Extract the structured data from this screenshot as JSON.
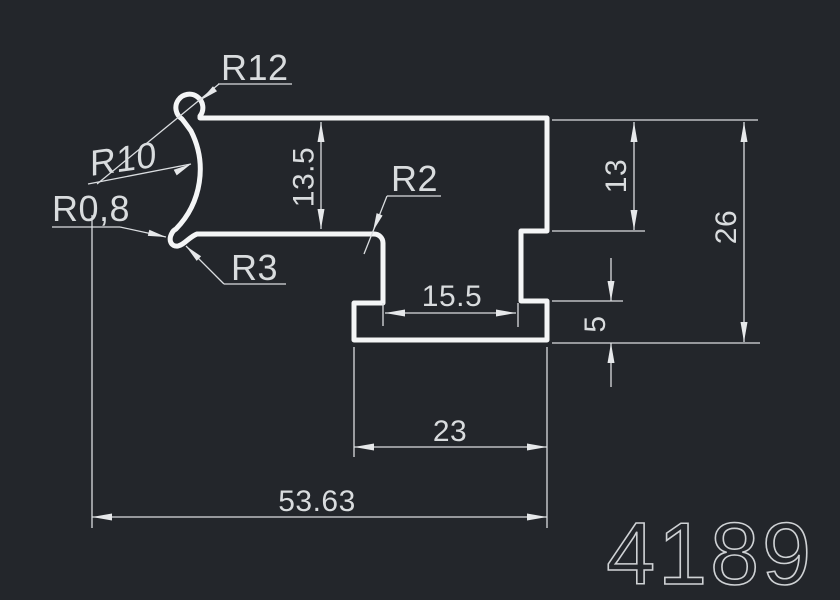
{
  "drawing": {
    "part_number": "4189",
    "background_color": "#23262b",
    "profile_stroke_color": "#f4f5f6",
    "dimension_line_color": "#dadde0",
    "text_color": "#d9dcde"
  },
  "dimensions": {
    "height_top_bar": "13.5",
    "height_right_upper": "13",
    "height_total": "26",
    "height_foot": "5",
    "width_channel": "15.5",
    "width_foot": "23",
    "width_total": "53.63"
  },
  "radius_labels": {
    "r12": "R12",
    "r10": "R10",
    "r0_8": "R0,8",
    "r3": "R3",
    "r2": "R2"
  }
}
